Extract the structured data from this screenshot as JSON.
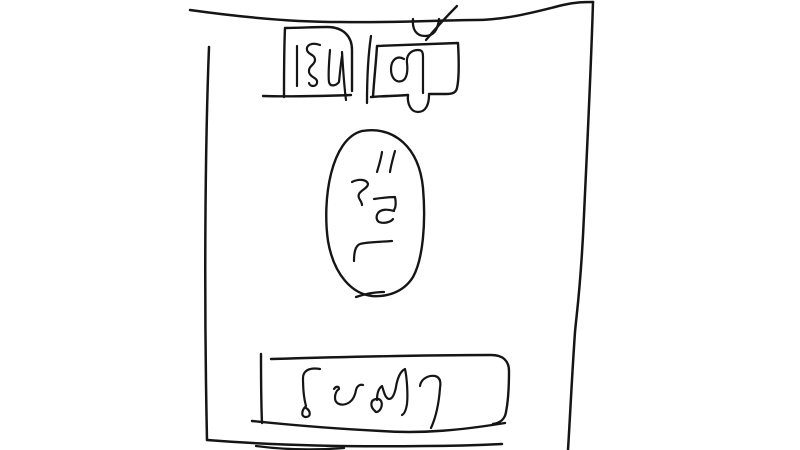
{
  "canvas": {
    "width": 800,
    "height": 450,
    "background": "#ffffff",
    "ink": "#151515"
  },
  "sketch": {
    "labels": {
      "top_left_box": "โซน",
      "top_right_box": "ตู้",
      "center_oval": "โต๊ะ",
      "bottom_box": "โซฟา"
    }
  },
  "strokes": [
    {
      "name": "room-wall-top",
      "w": 2.5,
      "d": "M190,10 C240,17 290,22 340,22 C395,23 445,20 475,20 C508,20 538,11 563,5 C575,2 585,2 593,2"
    },
    {
      "name": "room-wall-right",
      "w": 2.5,
      "d": "M593,2 C591,70 587,150 584,215 C581,285 577,310 575,332 C572,375 570,418 568,450"
    },
    {
      "name": "room-wall-left",
      "w": 2.5,
      "d": "M209,47 C205,150 204,300 207,440"
    },
    {
      "name": "room-wall-bottom",
      "w": 2.5,
      "d": "M207,440 C270,445 350,447 425,446 C455,446 482,445 502,444"
    },
    {
      "name": "room-wall-bottom-overdraw",
      "w": 2.3,
      "d": "M256,446 C286,450 318,450 344,448"
    },
    {
      "name": "cabinet-tone-mark-u",
      "w": 2.3,
      "d": "M413,19 C412,29 416,36 425,36 C434,36 438,29 439,19"
    },
    {
      "name": "cabinet-tone-mark-slash",
      "w": 2.3,
      "d": "M426,40 C436,28 447,16 457,6"
    },
    {
      "name": "top-left-box-outline",
      "w": 2.4,
      "d": "M284,97 C284,74 284,50 285,28 C299,28 314,27 327,27 C344,27 352,37 352,50 L352,91"
    },
    {
      "name": "top-left-box-bottom-edge",
      "w": 2.4,
      "d": "M351,95 C322,96 292,97 263,96"
    },
    {
      "name": "top-left-box-glyph-1",
      "w": 2.2,
      "d": "M297,46 L297,86"
    },
    {
      "name": "top-left-box-glyph-2",
      "w": 2.2,
      "d": "M320,45 C312,42 306,45 307,50 C308,55 315,54 315,60 C315,65 308,66 309,72 C310,78 318,77 317,83 C316,87 310,87 309,83"
    },
    {
      "name": "top-left-box-glyph-3",
      "w": 2.2,
      "d": "M330,50 C329,62 328,75 329,82 C330,87 336,86 339,82 C340,72 341,62 342,56"
    },
    {
      "name": "top-left-box-glyph-3-tail",
      "w": 2.2,
      "d": "M342,52 C343,68 344,85 346,100"
    },
    {
      "name": "cabinet-box-left-stroke",
      "w": 2.3,
      "d": "M371,36 C368,56 367,80 367,103"
    },
    {
      "name": "cabinet-box-outline",
      "w": 2.4,
      "d": "M373,97 C374,80 376,63 377,46 C404,45 431,44 458,43 C459,61 459,79 457,88 C456,93 452,94 446,94 C440,94 434,94 429,94"
    },
    {
      "name": "cabinet-box-bottom-left-edge",
      "w": 2.4,
      "d": "M408,95 C396,96 383,96 371,97"
    },
    {
      "name": "cabinet-vowel-u-below",
      "w": 2.3,
      "d": "M408,95 C407,104 411,112 418,112 C426,112 429,104 429,95"
    },
    {
      "name": "cabinet-glyph-to-tao",
      "w": 2.2,
      "d": "M404,59 C397,55 391,60 391,69 C391,78 396,83 402,81 C407,79 408,71 407,63 C406,55 411,50 418,50 C422,50 423,52 423,57 L423,93"
    },
    {
      "name": "table-oval-outline",
      "w": 2.4,
      "d": "M362,131 C394,126 419,147 423,188 C426,223 423,259 413,277 C403,293 386,297 372,296 C353,294 334,276 328,241 C322,199 331,139 362,131"
    },
    {
      "name": "table-oval-bottom-tick",
      "w": 2.3,
      "d": "M356,297 C365,294 375,292 384,292"
    },
    {
      "name": "table-glyph-mark-1",
      "w": 2.2,
      "d": "M382,152 C381,159 379,165 377,172"
    },
    {
      "name": "table-glyph-mark-2",
      "w": 2.2,
      "d": "M395,151 C393,158 391,165 390,172"
    },
    {
      "name": "table-glyph-s-curve",
      "w": 2.2,
      "d": "M352,182 C360,178 367,180 368,184 C368,188 361,190 359,194 C357,198 362,201 362,205"
    },
    {
      "name": "table-glyph-loop",
      "w": 2.2,
      "d": "M374,199 C381,198 388,197 395,197 C396,202 396,207 394,210 M394,211 C388,209 381,209 378,213 C376,216 376,220 379,222 C384,224 391,222 393,219"
    },
    {
      "name": "table-glyph-hook",
      "w": 2.2,
      "d": "M392,241 C380,242 366,242 360,244 C355,246 354,253 354,261"
    },
    {
      "name": "sofa-left-bar",
      "w": 2.4,
      "d": "M261,354 C261,377 261,400 262,423"
    },
    {
      "name": "sofa-box-outline",
      "w": 2.4,
      "d": "M271,359 C340,357 425,355 491,355 C503,355 509,361 509,371 C509,386 508,402 506,412 C505,419 500,423 493,424"
    },
    {
      "name": "sofa-box-bottom-edge",
      "w": 2.4,
      "d": "M505,423 C462,430 422,434 381,431 C339,429 291,425 252,421"
    },
    {
      "name": "sofa-glyph-o",
      "w": 2.2,
      "d": "M320,369 C309,367 303,371 303,378 C303,390 304,399 306,406 C301,411 301,417 306,417 C311,417 311,411 306,408"
    },
    {
      "name": "sofa-glyph-so",
      "w": 2.2,
      "d": "M334,389 C336,386 339,386 339,389 C336,391 335,394 335,398 C335,403 340,406 346,404 C352,402 355,396 356,390 C357,386 360,384 363,385"
    },
    {
      "name": "sofa-glyph-fo",
      "w": 2.2,
      "d": "M375,411 C370,407 370,400 376,399 C381,398 383,403 381,408 C379,412 376,413 375,411 M377,400 C377,393 379,388 382,386 C384,392 385,398 389,399 C393,399 395,392 396,387 C397,380 400,371 405,369 C407,378 408,395 407,404 C406,410 404,414 402,415"
    },
    {
      "name": "sofa-glyph-aa",
      "w": 2.2,
      "d": "M420,386 C421,379 428,375 435,376 C440,377 441,382 440,388 C439,402 436,417 431,428"
    }
  ]
}
